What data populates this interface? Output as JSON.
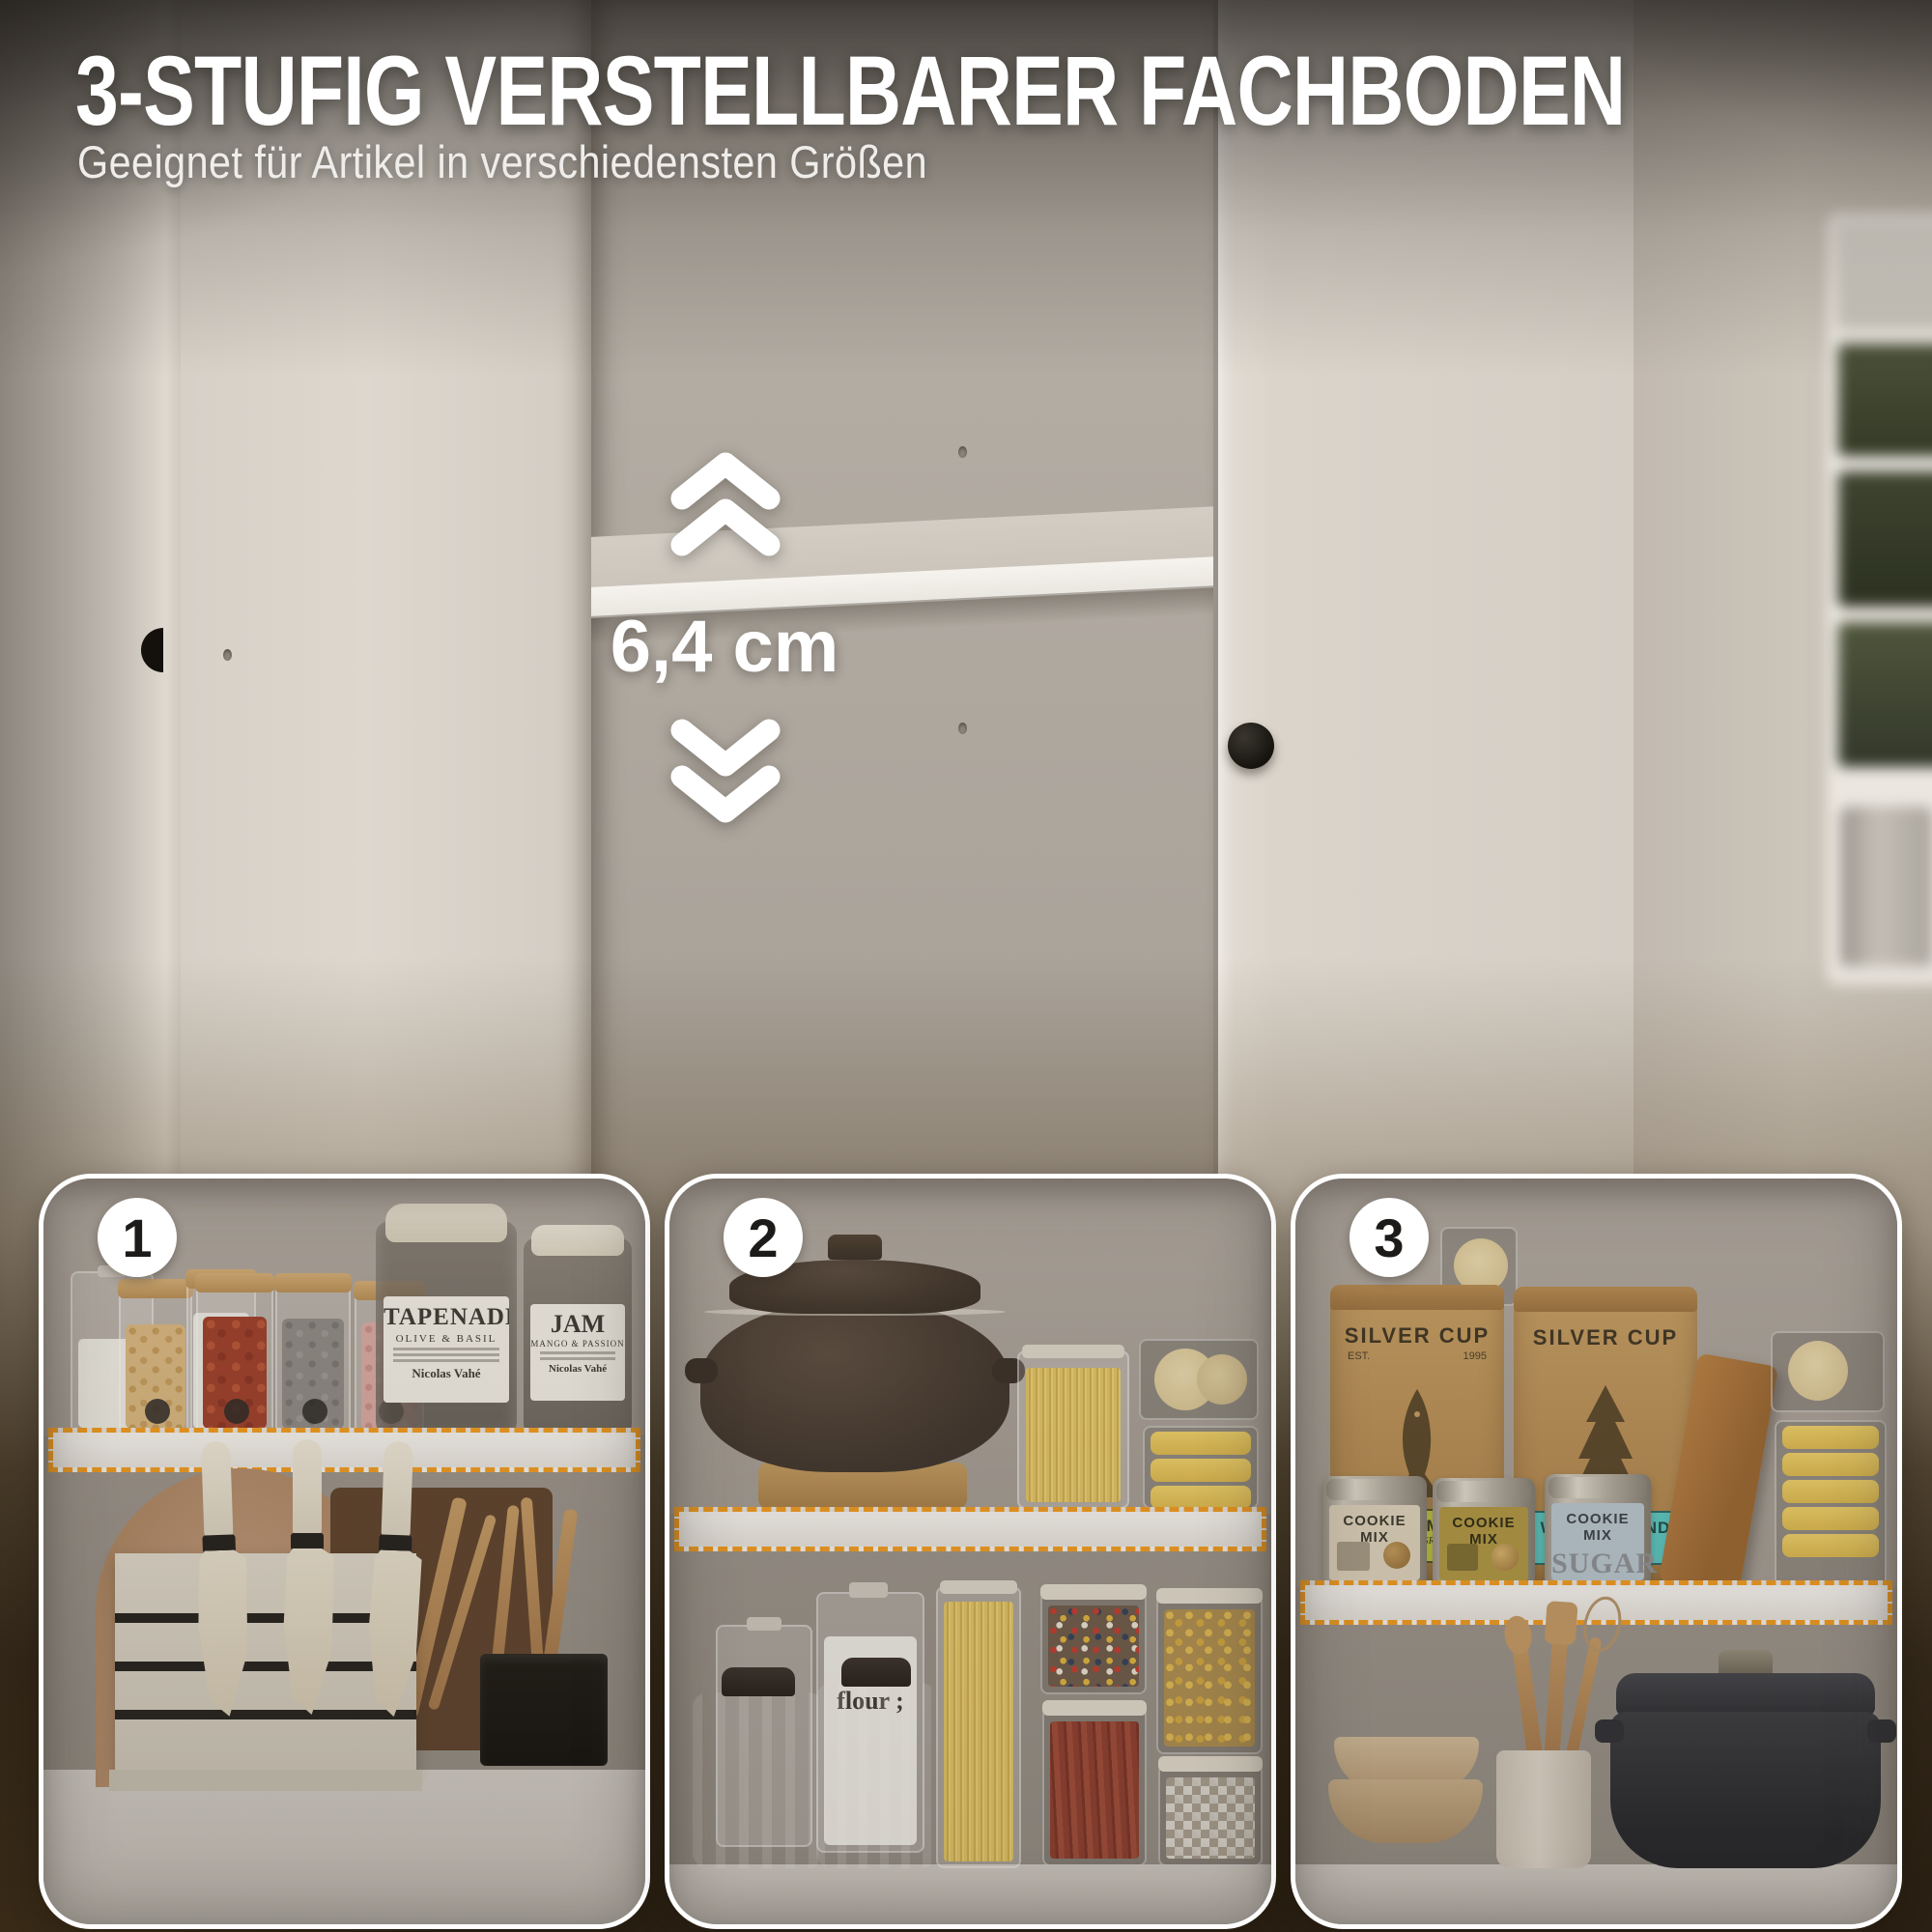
{
  "header": {
    "title": "3-STUFIG VERSTELLBARER FACHBODEN",
    "subtitle": "Geeignet für Artikel in verschiedensten Größen"
  },
  "hero": {
    "measurement": "6,4 cm",
    "up_icon": "double-chevron-up",
    "down_icon": "double-chevron-down"
  },
  "panels": [
    {
      "number": "1",
      "labels": {
        "tapenade_title": "TAPENADE",
        "tapenade_sub": "OLIVE & BASIL",
        "tapenade_brand": "Nicolas Vahé",
        "jam_title": "JAM",
        "jam_sub": "MANGO & PASSION",
        "jam_brand": "Nicolas Vahé"
      }
    },
    {
      "number": "2",
      "labels": {
        "flour": "flour ;"
      }
    },
    {
      "number": "3",
      "labels": {
        "bag1_brand": "SILVER CUP",
        "bag1_est": "EST.",
        "bag1_year": "1995",
        "bag1_tag": "SNOHO MOJO",
        "bag1_tag_sub": "COARSE GRIND",
        "bag2_brand": "SILVER CUP",
        "bag2_tag": "WONDERLAND",
        "bag2_tag_sub": "WHOLE BEAN",
        "tin1_label": "COOKIE MIX",
        "tin2_label": "COOKIE MIX",
        "tin3_label": "COOKIE MIX",
        "tin3_word": "SUGAR"
      }
    }
  ],
  "colors": {
    "accent_orange": "#F29B1D",
    "title_white": "#FFFFFF",
    "badge_text": "#1C1B19",
    "bottom_brown": "#2A2013",
    "shelf_white": "#F2EFEA",
    "tag_yellow": "#C9CF45",
    "tag_teal": "#5BC8C2"
  }
}
